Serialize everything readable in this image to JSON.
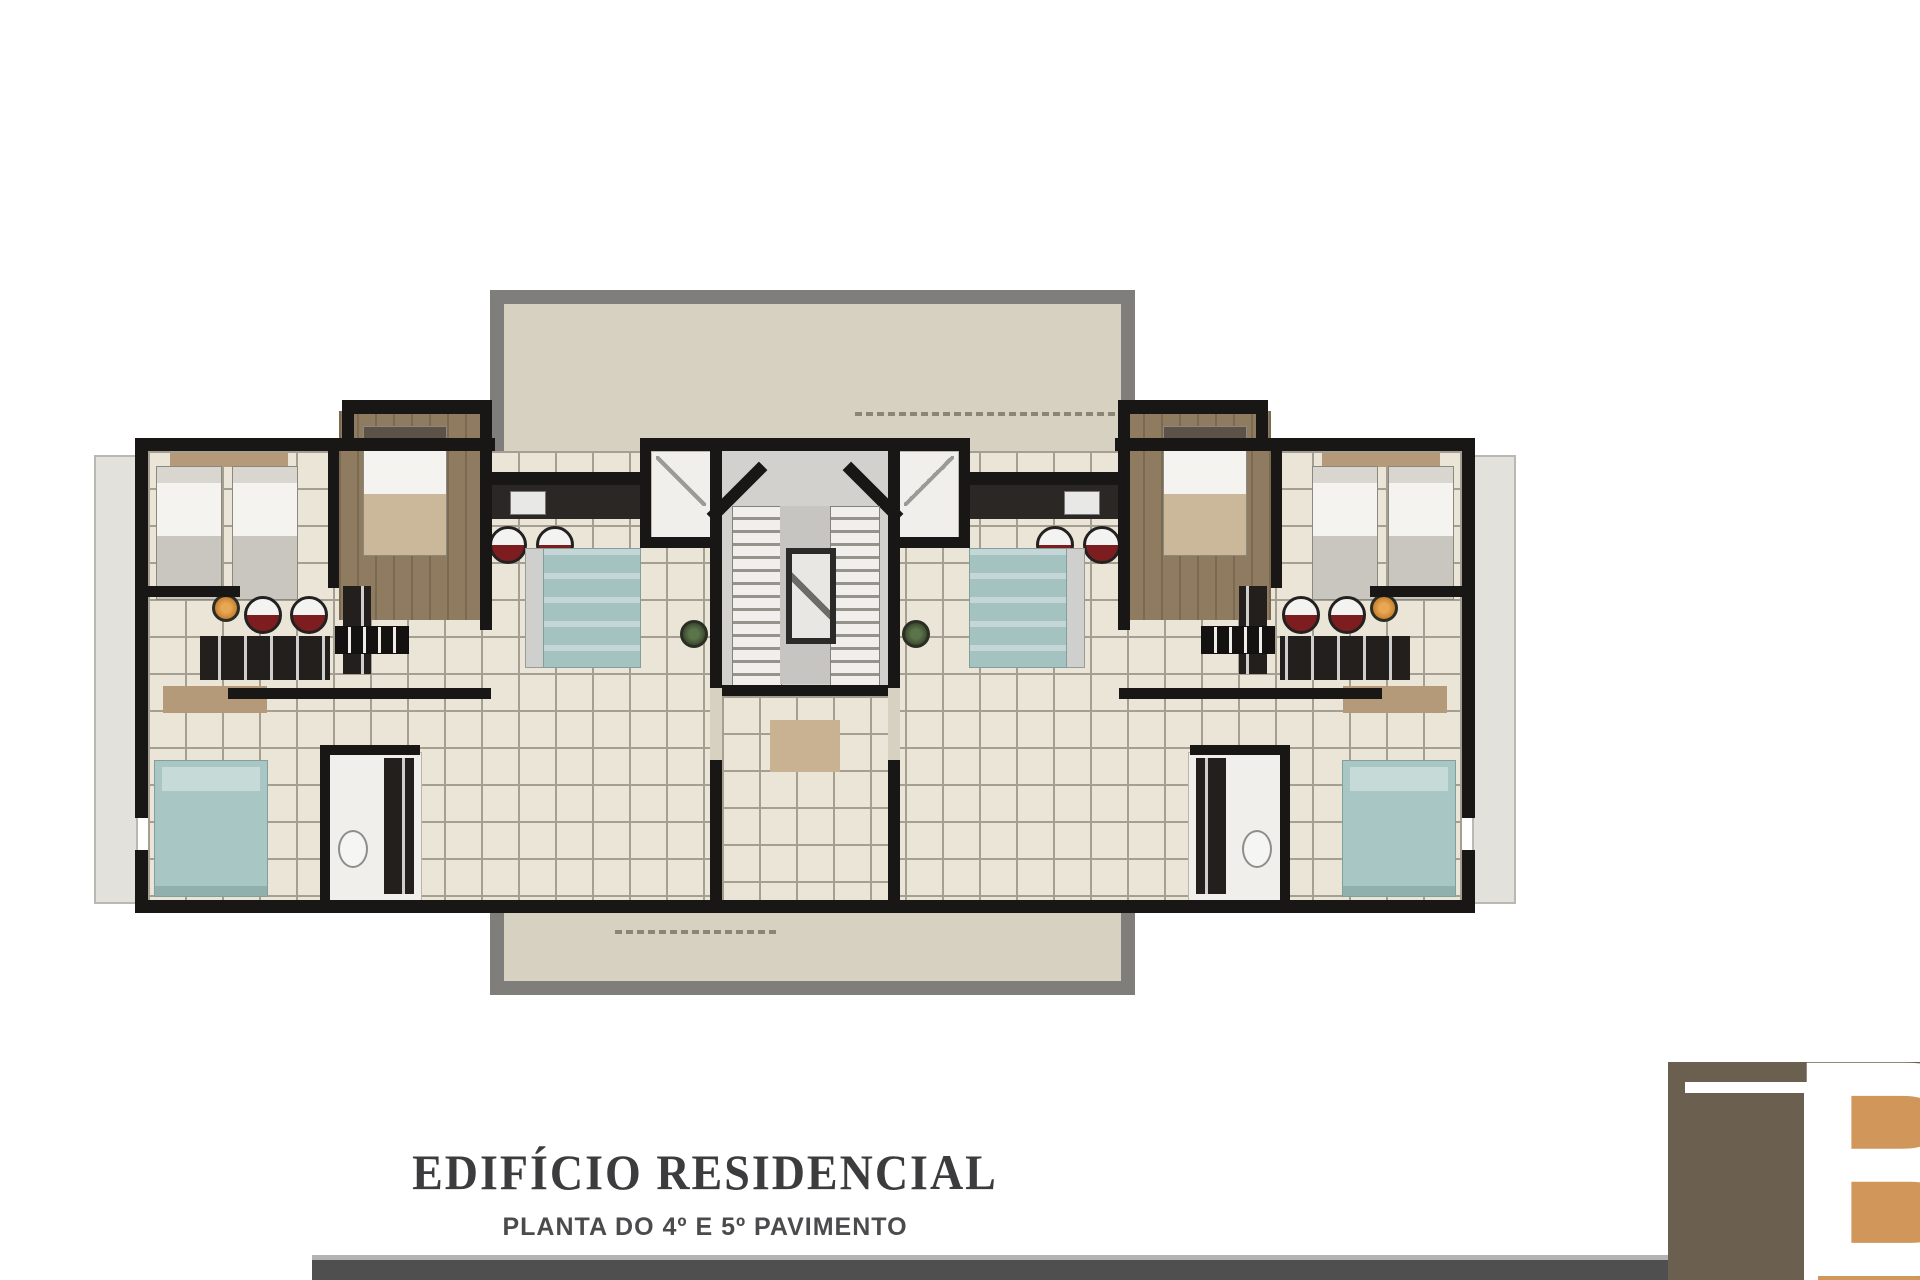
{
  "document": {
    "title": "EDIFÍCIO RESIDENCIAL",
    "subtitle": "PLANTA DO 4º E 5º PAVIMENTO"
  },
  "logo": {
    "letter_b": "B",
    "monogram": "TB",
    "taupe_color": "#6b6050",
    "orange_color": "#d0965a"
  },
  "plan": {
    "type": "residential-floor-plan",
    "symmetry": "mirrored left/right apartments around central stair core",
    "palette": {
      "wall": "#191715",
      "tile_floor": "#ebe5d7",
      "tile_line": "#a59f92",
      "terrace_fill": "#d7d1c2",
      "terrace_border": "#7f7e7a",
      "wood_floor": "#8f7b5f",
      "teal_furniture": "#a8c6c3",
      "stool_red": "#7e1d20",
      "plant_orange": "#c97f2f",
      "plant_green": "#3c4c30",
      "stair_floor": "#d2d1cd",
      "footer_bar": "#4f4f4f"
    }
  }
}
